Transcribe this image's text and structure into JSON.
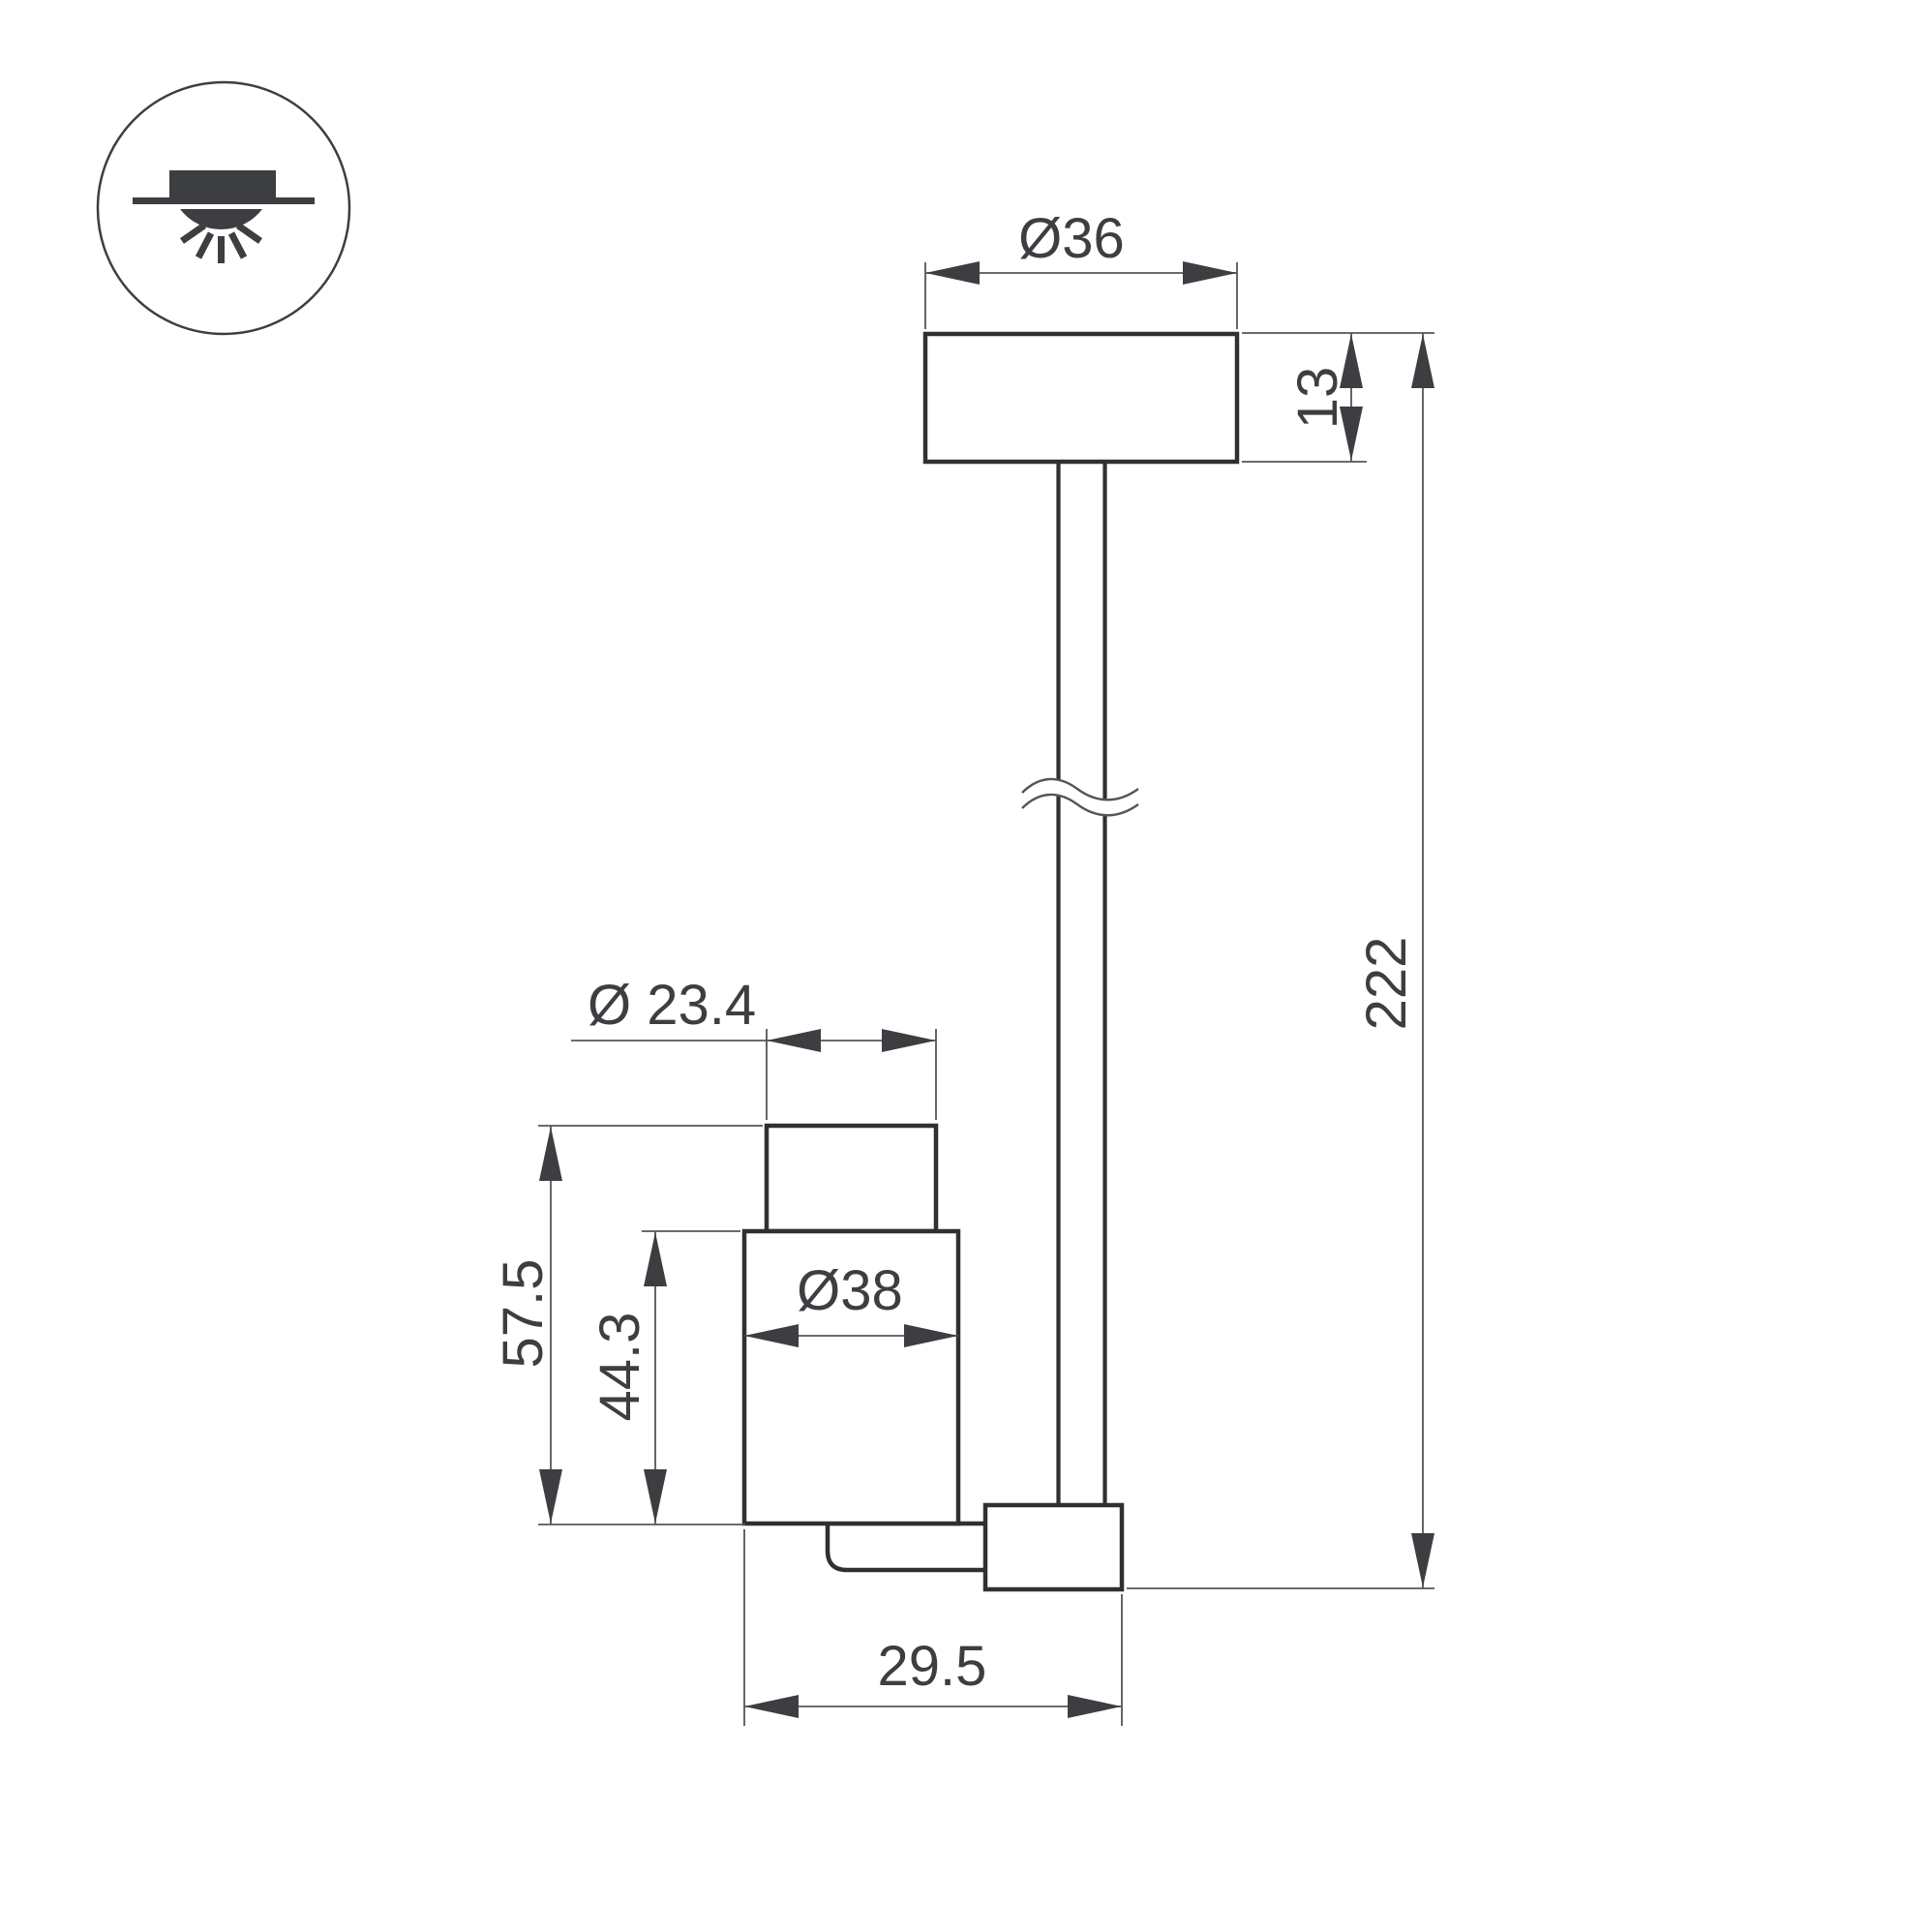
{
  "drawing": {
    "title": "luminaire-dimension-drawing",
    "icon": {
      "name": "surface-mounted-downlight-icon"
    },
    "dimensions": {
      "canopy_diameter": "Ø36",
      "canopy_height": "13",
      "total_length": "222",
      "head_top_diameter": "Ø 23.4",
      "head_total_height": "57.5",
      "head_body_height": "44.3",
      "head_body_diameter": "Ø38",
      "head_depth": "29.5"
    },
    "colors": {
      "outline": "#2f3033",
      "dimension_lines": "#55565a",
      "text_and_arrows": "#3d3e41",
      "background": "#ffffff"
    }
  }
}
